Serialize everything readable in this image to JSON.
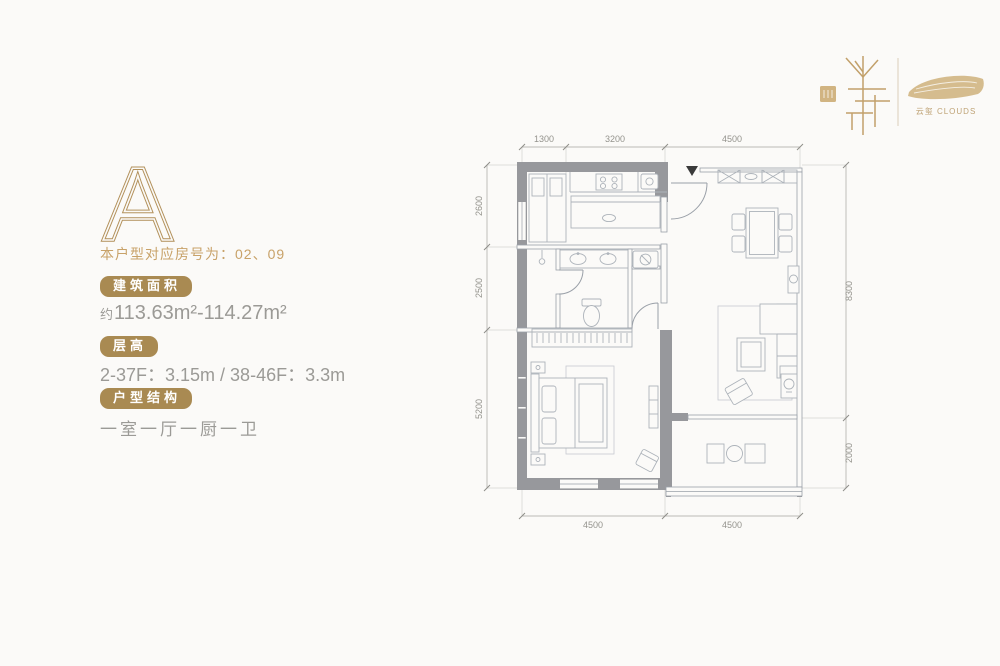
{
  "page": {
    "title": "户型 A 平面图"
  },
  "unit_panel": {
    "unit_letter": "A",
    "room_line": "本户型对应房号为：02、09",
    "area": {
      "badge": "建筑面积",
      "prefix": "约",
      "value": "113.63m²-114.27m²"
    },
    "floor_height": {
      "badge": "层高",
      "value": "2-37F：3.15m / 38-46F：3.3m"
    },
    "structure": {
      "badge": "户型结构",
      "value": "一室一厅一厨一卫"
    }
  },
  "brand": {
    "caption": "云玺 CLOUDS"
  },
  "floor_plan": {
    "dims": {
      "top": [
        "1300",
        "3200",
        "4500"
      ],
      "left": [
        "2600",
        "2500",
        "5200"
      ],
      "right": [
        "8300",
        "2000"
      ],
      "bottom": [
        "4500",
        "4500"
      ]
    }
  },
  "colors": {
    "gold": "#b2905a",
    "badge_bg": "#a98a52",
    "text_gray": "#9b9a96",
    "plan_line": "#9aa0a8",
    "wall_fill": "#97989c"
  }
}
